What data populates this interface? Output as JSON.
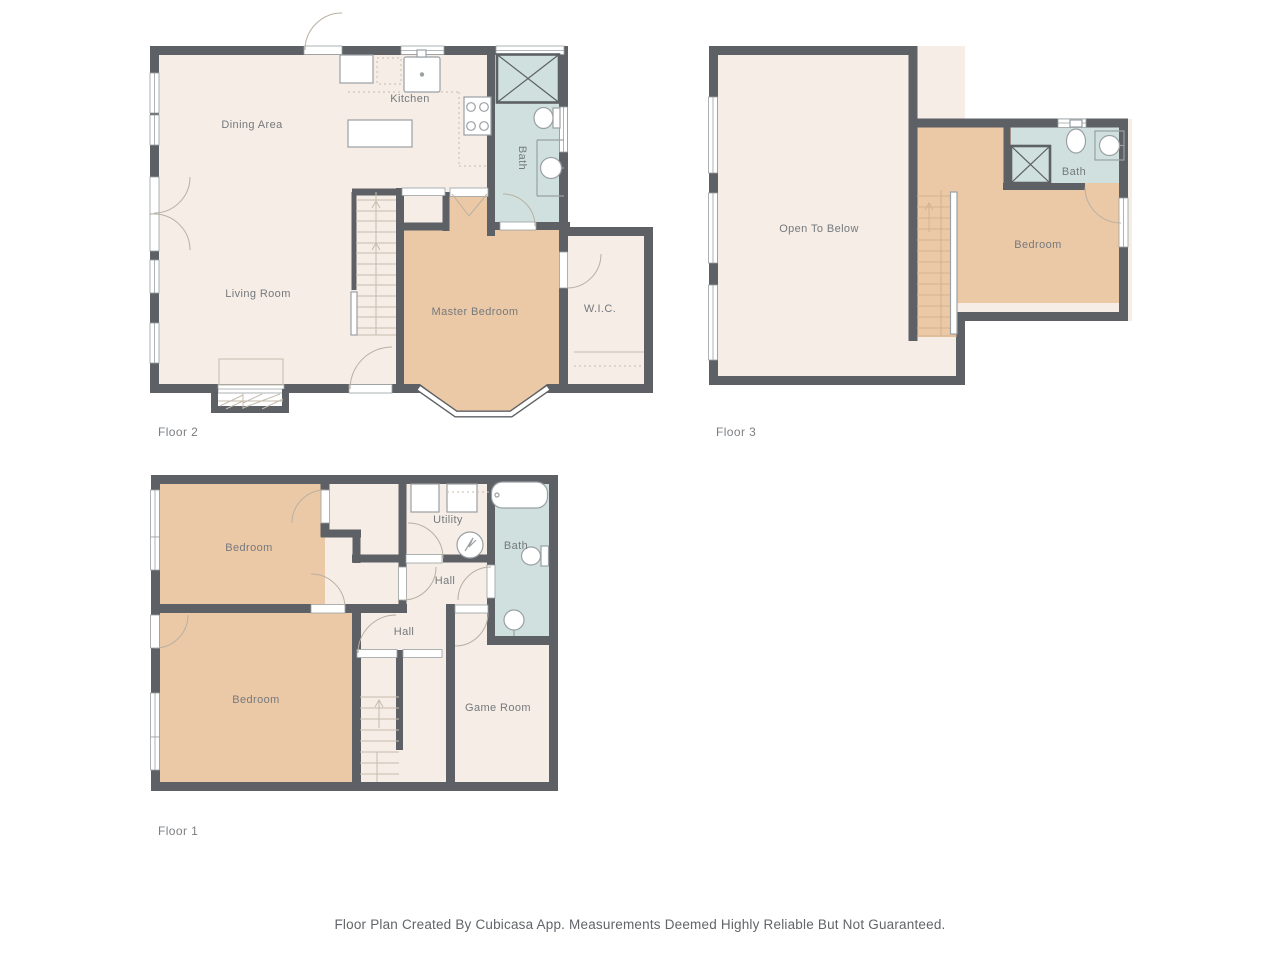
{
  "footer": {
    "disclaimer": "Floor Plan Created By Cubicasa App. Measurements Deemed Highly Reliable But Not Guaranteed."
  },
  "colors": {
    "wall": "#5d6064",
    "cream": "#f5ede6",
    "peach": "#ecc9a6",
    "blue": "#cfe0df",
    "fixture_line": "#9aa0a3",
    "door_arc": "#b9b0a2",
    "detail_line": "#c6bcae",
    "detail_line_warm": "#d3b48e",
    "room_label": "#75797d",
    "floor_label": "#7b7f83",
    "footer_text": "#616569"
  },
  "floors": [
    {
      "label": "Floor 2",
      "rooms": {
        "dining": "Dining Area",
        "kitchen": "Kitchen",
        "living": "Living Room",
        "bath": "Bath",
        "master": "Master Bedroom",
        "wic": "W.I.C."
      }
    },
    {
      "label": "Floor 3",
      "rooms": {
        "open": "Open To Below",
        "bedroom": "Bedroom",
        "bath": "Bath"
      }
    },
    {
      "label": "Floor 1",
      "rooms": {
        "bedroom_top": "Bedroom",
        "bedroom_bottom": "Bedroom",
        "utility": "Utility",
        "hall_upper": "Hall",
        "hall_lower": "Hall",
        "bath": "Bath",
        "game_room": "Game Room"
      }
    }
  ]
}
